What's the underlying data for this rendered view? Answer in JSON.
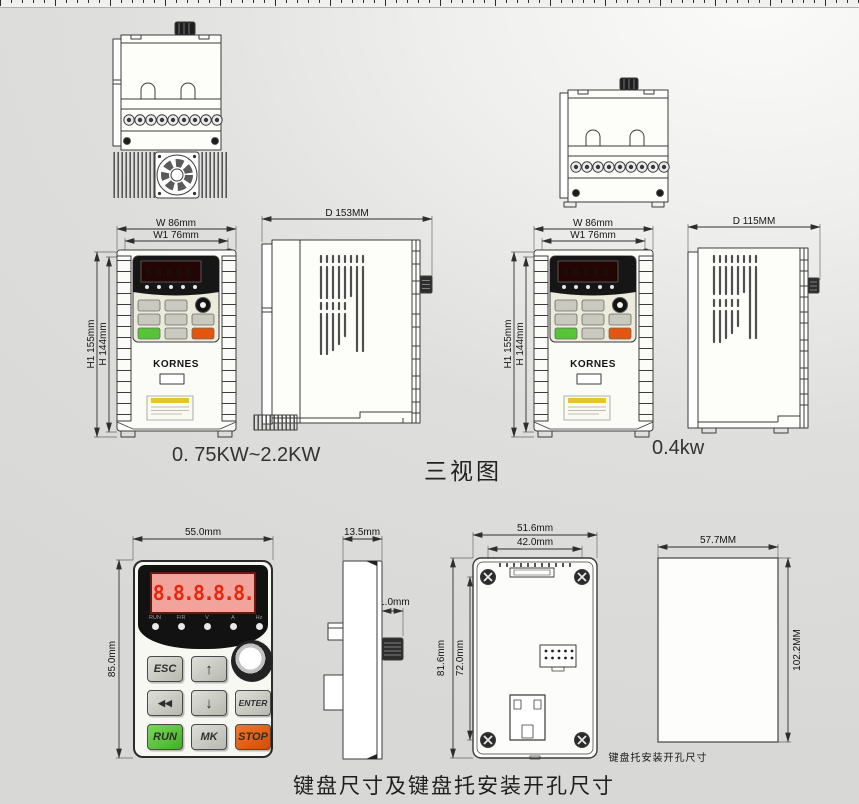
{
  "titles": {
    "three_views": "三视图",
    "bottom_caption": "键盘尺寸及键盘托安装开孔尺寸",
    "model_left": "0. 75KW~2.2KW",
    "model_right": "0.4kw",
    "cutout_caption": "键盘托安装开孔尺寸"
  },
  "dims": {
    "front_w": "W  86mm",
    "front_w1": "W1 76mm",
    "front_h1": "H1 155mm",
    "front_h": "H  144mm",
    "side_left_d": "D 153MM",
    "side_right_d": "D 115MM",
    "kp_width": "55.0mm",
    "kp_height": "85.0mm",
    "kp_depth": "13.5mm",
    "kp_knob": "11.0mm",
    "back_outer_w": "51.6mm",
    "back_hole_w": "42.0mm",
    "back_outer_h": "81.6mm",
    "back_hole_h": "72.0mm",
    "cutout_w": "57.7MM",
    "cutout_h": "102.2MM"
  },
  "keypad": {
    "display": "8.8.8.8.8.",
    "logo": "KORNES",
    "leds": [
      "RUN",
      "F/R",
      "V",
      "A",
      "Hz"
    ],
    "buttons": {
      "esc": "ESC",
      "up": "↑",
      "left": "◀◀",
      "down": "↓",
      "enter": "ENTER",
      "run": "RUN",
      "mk": "MK",
      "stop": "STOP"
    }
  },
  "colors": {
    "run_green": "#57c437",
    "stop_orange": "#e4560e",
    "display_red": "#e8260c",
    "display_pink": "#f2a49c",
    "logo_blue": "#2b5fd4"
  }
}
